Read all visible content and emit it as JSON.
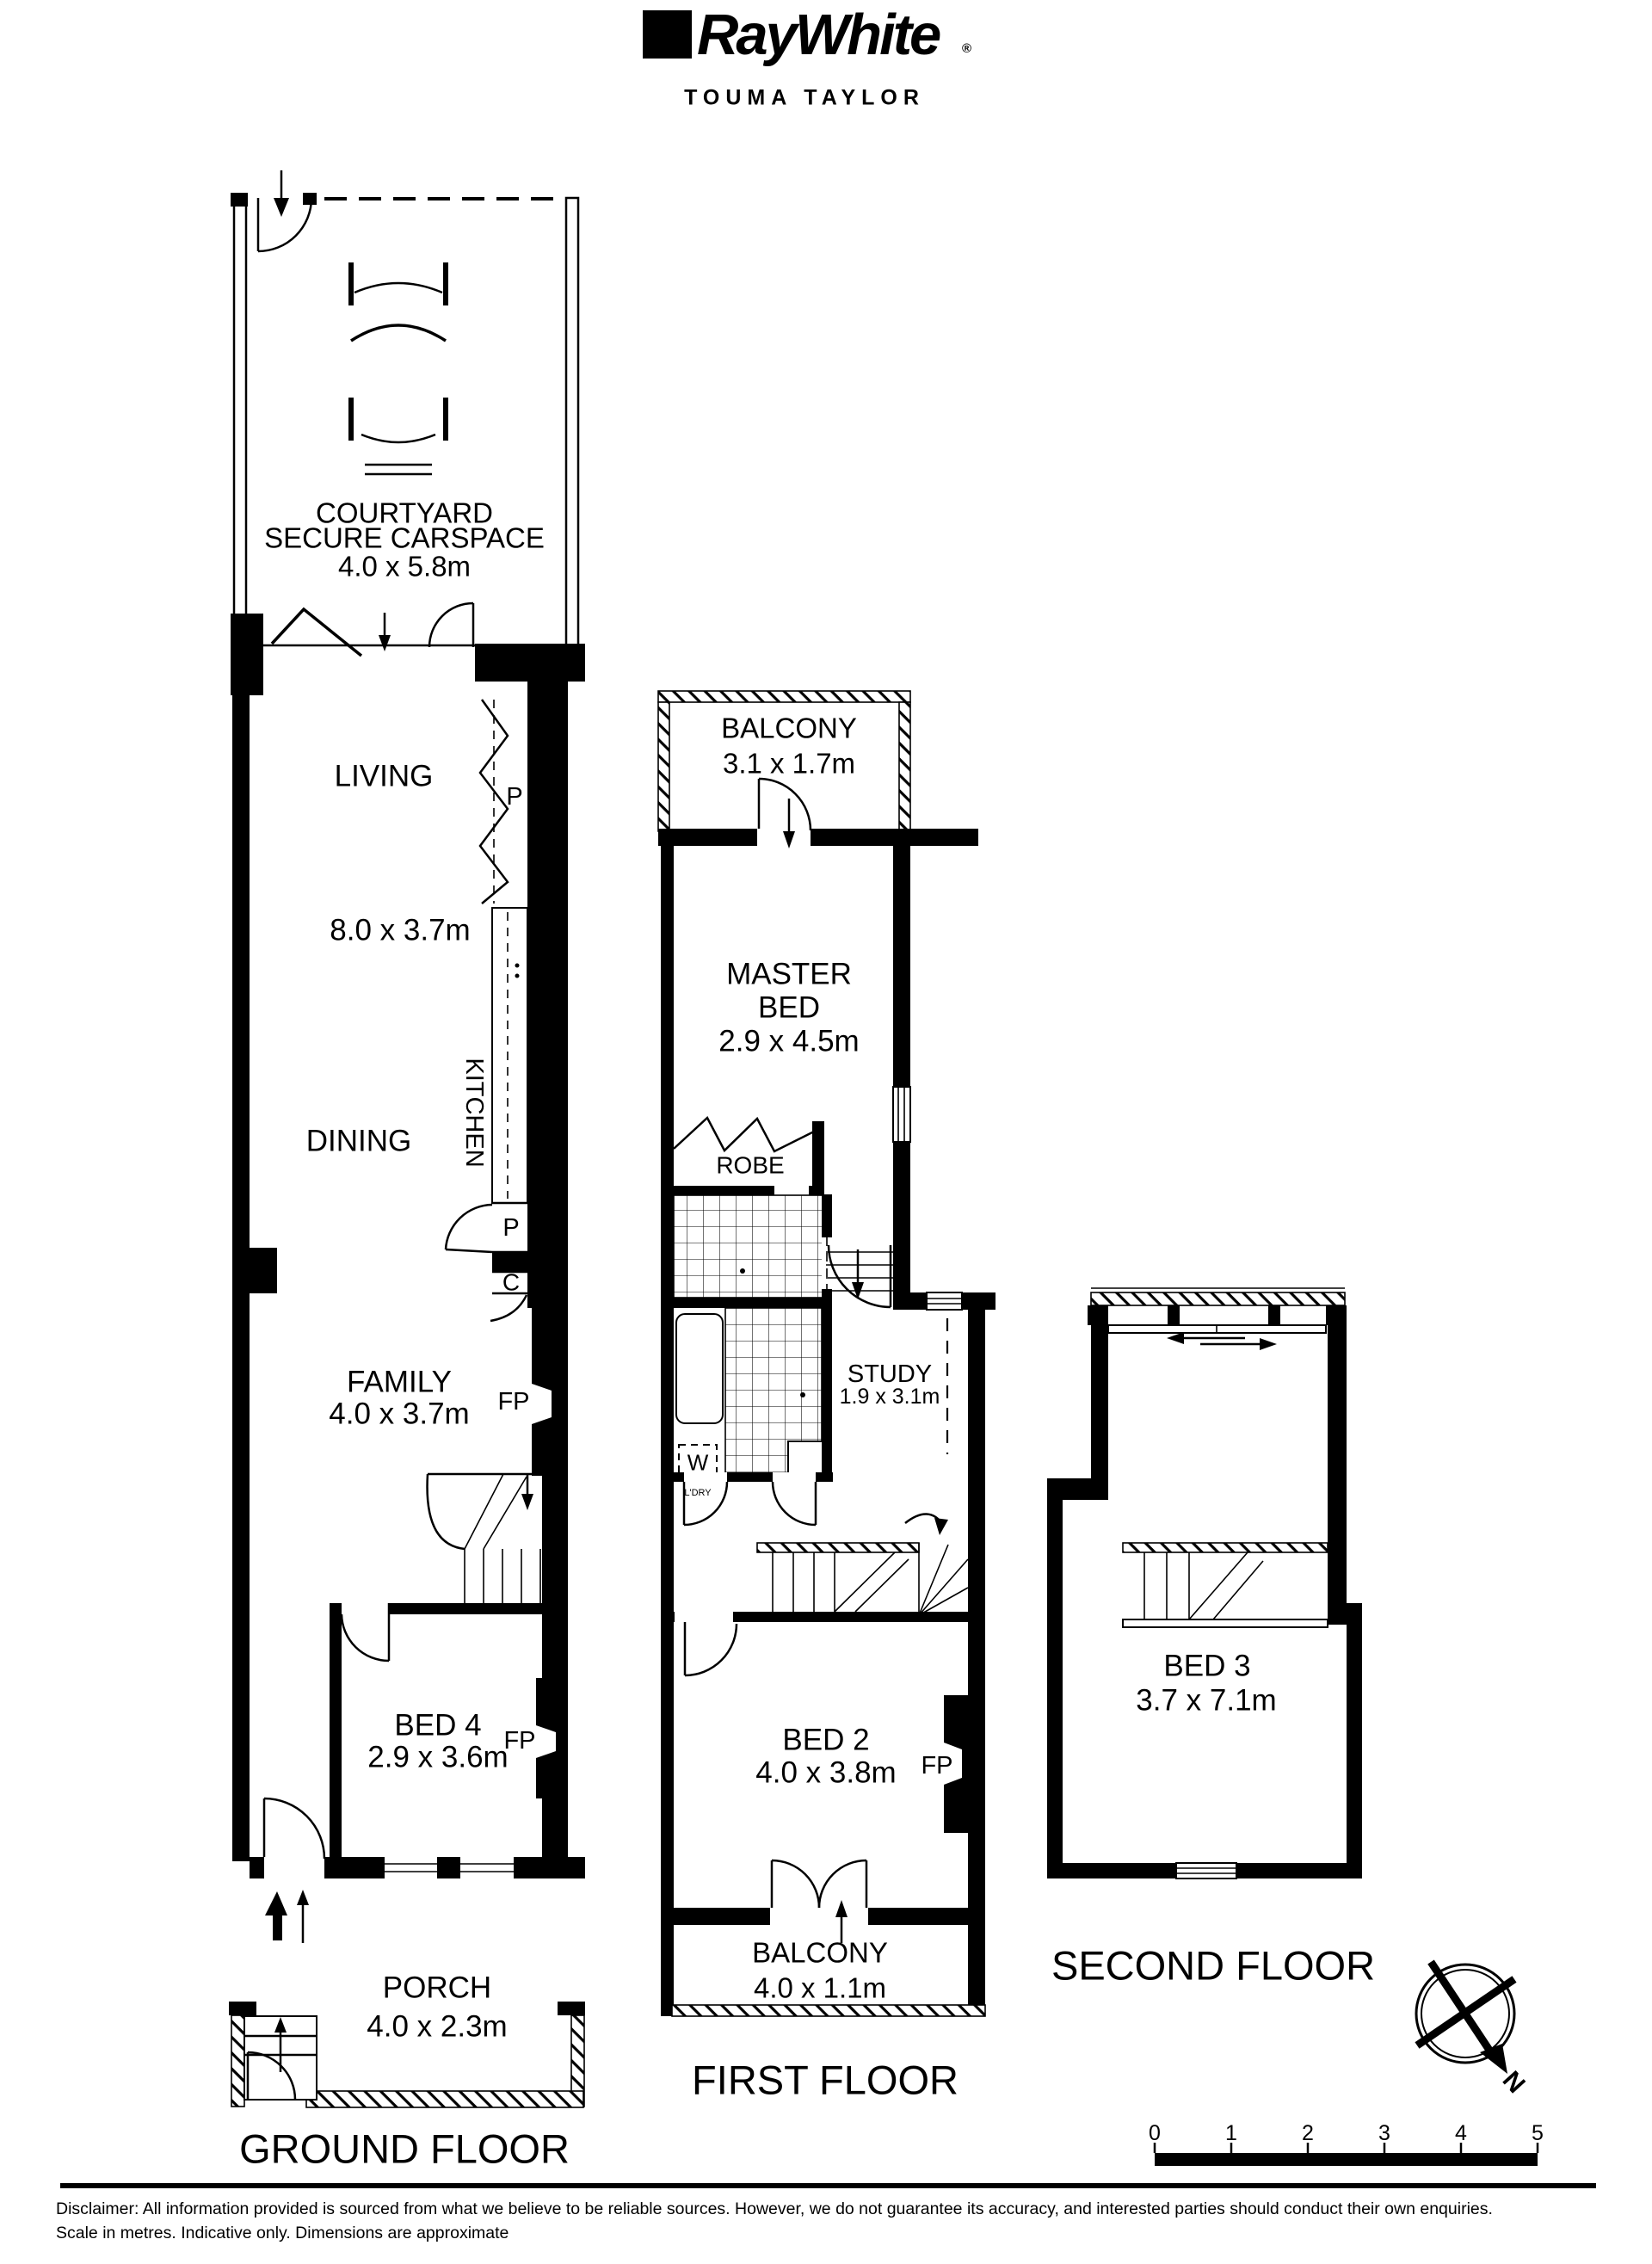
{
  "header": {
    "brand": "RayWhite",
    "registered": "®",
    "office": "TOUMA TAYLOR"
  },
  "ground_floor": {
    "title": "GROUND FLOOR",
    "courtyard": {
      "name_line1": "COURTYARD",
      "name_line2": "SECURE CARSPACE",
      "dims": "4.0 x 5.8m"
    },
    "living": {
      "name": "LIVING",
      "dims": "8.0 x 3.7m"
    },
    "dining": {
      "name": "DINING"
    },
    "kitchen": {
      "name": "KITCHEN"
    },
    "passage_label": "P",
    "pantry_label": "P",
    "cupboard_label": "C",
    "family": {
      "name": "FAMILY",
      "dims": "4.0 x 3.7m"
    },
    "family_fp": "FP",
    "bed4": {
      "name": "BED 4",
      "dims": "2.9 x 3.6m"
    },
    "bed4_fp": "FP",
    "porch": {
      "name": "PORCH",
      "dims": "4.0 x 2.3m"
    }
  },
  "first_floor": {
    "title": "FIRST FLOOR",
    "balcony_top": {
      "name": "BALCONY",
      "dims": "3.1 x 1.7m"
    },
    "master_bed": {
      "name_line1": "MASTER",
      "name_line2": "BED",
      "dims": "2.9 x 4.5m"
    },
    "robe": {
      "name": "ROBE"
    },
    "study": {
      "name": "STUDY",
      "dims": "1.9 x 3.1m"
    },
    "laundry": {
      "washer_label": "W",
      "name": "L'DRY"
    },
    "bed2": {
      "name": "BED 2",
      "dims": "4.0 x 3.8m"
    },
    "bed2_fp": "FP",
    "balcony_bottom": {
      "name": "BALCONY",
      "dims": "4.0 x 1.1m"
    }
  },
  "second_floor": {
    "title": "SECOND FLOOR",
    "bed3": {
      "name": "BED 3",
      "dims": "3.7 x 7.1m"
    }
  },
  "compass": {
    "north_label": "N"
  },
  "scale_bar": {
    "ticks": [
      "0",
      "1",
      "2",
      "3",
      "4",
      "5"
    ]
  },
  "footer": {
    "disclaimer_line1": "Disclaimer: All information provided is sourced from what we believe to be reliable sources. However, we do not guarantee  its  accuracy, and interested parties should conduct their own enquiries.",
    "disclaimer_line2": "Scale in metres. Indicative only. Dimensions are approximate"
  }
}
